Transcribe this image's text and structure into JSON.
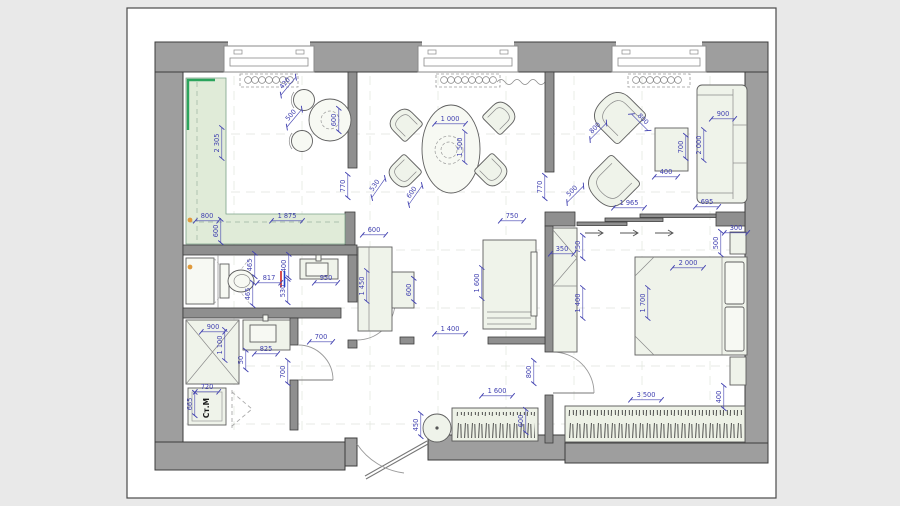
{
  "canvas": {
    "bg": "#e9e9e9",
    "page_bg": "#ffffff",
    "page_border": "#4a4a4a"
  },
  "colors": {
    "bg": "#e9e9e9",
    "dim": "#4040b0",
    "wall_fill": "#9e9e9e",
    "wall_stroke": "#3c3c3c",
    "partition_fill": "#8f8f8f",
    "furniture_fill": "#eff3ea",
    "furniture_stroke": "#5f5f5f",
    "counter_fill": "#e0ebd8",
    "counter_accent": "#2ba45c",
    "hatch": "#3f3f3f",
    "label_dark": "#1a1a1a",
    "plumb_red": "#cc2222",
    "plumb_blue": "#2244cc",
    "marker_orange": "#e09a3c"
  },
  "labels": {
    "washing_machine": "Ст.М"
  },
  "dimensions": [
    {
      "t": "2 305",
      "x": 220,
      "y": 143,
      "r": -90
    },
    {
      "t": "800",
      "x": 207,
      "y": 219,
      "r": 0
    },
    {
      "t": "1 875",
      "x": 287,
      "y": 219,
      "r": 0
    },
    {
      "t": "600",
      "x": 219,
      "y": 231,
      "r": -90
    },
    {
      "t": "770",
      "x": 346,
      "y": 186,
      "r": -90
    },
    {
      "t": "420",
      "x": 287,
      "y": 85,
      "r": -50
    },
    {
      "t": "500",
      "x": 293,
      "y": 117,
      "r": -50
    },
    {
      "t": "600",
      "x": 337,
      "y": 120,
      "r": -90
    },
    {
      "t": "1 000",
      "x": 450,
      "y": 122,
      "r": 0
    },
    {
      "t": "1 500",
      "x": 463,
      "y": 147,
      "r": -90
    },
    {
      "t": "530",
      "x": 377,
      "y": 187,
      "r": -55
    },
    {
      "t": "600",
      "x": 414,
      "y": 194,
      "r": -55
    },
    {
      "t": "770",
      "x": 543,
      "y": 187,
      "r": -90
    },
    {
      "t": "750",
      "x": 512,
      "y": 219,
      "r": 0
    },
    {
      "t": "800",
      "x": 597,
      "y": 130,
      "r": -45
    },
    {
      "t": "800",
      "x": 641,
      "y": 121,
      "r": 45
    },
    {
      "t": "500",
      "x": 574,
      "y": 193,
      "r": -45
    },
    {
      "t": "1 965",
      "x": 629,
      "y": 206,
      "r": 0
    },
    {
      "t": "400",
      "x": 666,
      "y": 175,
      "r": 0
    },
    {
      "t": "700",
      "x": 684,
      "y": 147,
      "r": -90
    },
    {
      "t": "900",
      "x": 723,
      "y": 117,
      "r": 0
    },
    {
      "t": "2 000",
      "x": 702,
      "y": 145,
      "r": -90
    },
    {
      "t": "695",
      "x": 707,
      "y": 205,
      "r": 0
    },
    {
      "t": "300",
      "x": 736,
      "y": 231,
      "r": 0
    },
    {
      "t": "500",
      "x": 719,
      "y": 243,
      "r": -90
    },
    {
      "t": "2 000",
      "x": 688,
      "y": 266,
      "r": 0
    },
    {
      "t": "1 700",
      "x": 646,
      "y": 303,
      "r": -90
    },
    {
      "t": "350",
      "x": 562,
      "y": 252,
      "r": 0
    },
    {
      "t": "750",
      "x": 581,
      "y": 247,
      "r": -90
    },
    {
      "t": "1 400",
      "x": 581,
      "y": 303,
      "r": -90
    },
    {
      "t": "3 500",
      "x": 646,
      "y": 398,
      "r": 0
    },
    {
      "t": "400",
      "x": 722,
      "y": 397,
      "r": -90
    },
    {
      "t": "800",
      "x": 532,
      "y": 372,
      "r": -90
    },
    {
      "t": "600",
      "x": 374,
      "y": 233,
      "r": 0
    },
    {
      "t": "1 450",
      "x": 365,
      "y": 286,
      "r": -90
    },
    {
      "t": "600",
      "x": 412,
      "y": 290,
      "r": -90
    },
    {
      "t": "1 600",
      "x": 480,
      "y": 283,
      "r": -90
    },
    {
      "t": "1 400",
      "x": 450,
      "y": 332,
      "r": 0
    },
    {
      "t": "450",
      "x": 419,
      "y": 425,
      "r": -90
    },
    {
      "t": "1 600",
      "x": 497,
      "y": 394,
      "r": 0
    },
    {
      "t": "600",
      "x": 524,
      "y": 421,
      "r": -90
    },
    {
      "t": "465",
      "x": 253,
      "y": 265,
      "r": -90
    },
    {
      "t": "465",
      "x": 251,
      "y": 294,
      "r": -90
    },
    {
      "t": "817",
      "x": 269,
      "y": 281,
      "r": 0
    },
    {
      "t": "400",
      "x": 287,
      "y": 266,
      "r": -90
    },
    {
      "t": "530",
      "x": 286,
      "y": 291,
      "r": -90
    },
    {
      "t": "950",
      "x": 326,
      "y": 281,
      "r": 0
    },
    {
      "t": "700",
      "x": 321,
      "y": 340,
      "r": 0
    },
    {
      "t": "700",
      "x": 286,
      "y": 372,
      "r": -90
    },
    {
      "t": "900",
      "x": 213,
      "y": 330,
      "r": 0
    },
    {
      "t": "1 100",
      "x": 223,
      "y": 345,
      "r": -90
    },
    {
      "t": "825",
      "x": 266,
      "y": 352,
      "r": 0
    },
    {
      "t": "50",
      "x": 244,
      "y": 360,
      "r": -90
    },
    {
      "t": "720",
      "x": 207,
      "y": 390,
      "r": 0
    },
    {
      "t": "665",
      "x": 193,
      "y": 404,
      "r": -90
    }
  ]
}
